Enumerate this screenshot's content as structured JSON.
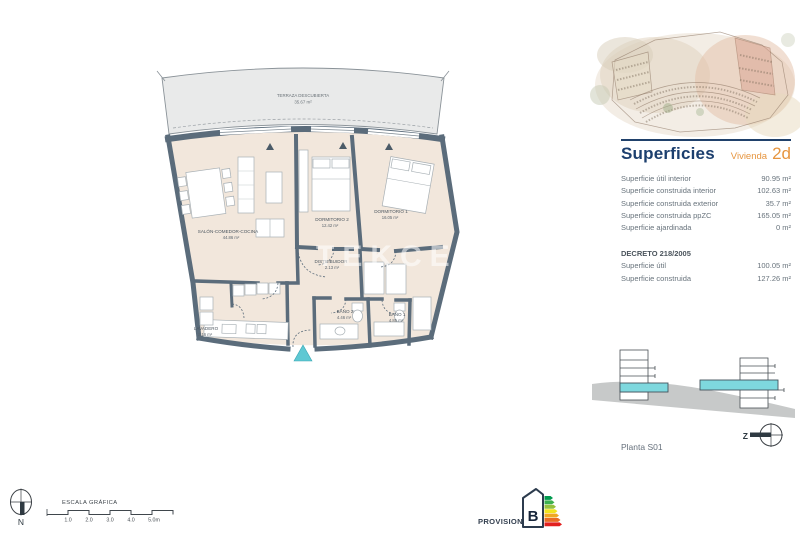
{
  "watermark": "TEKCE",
  "plan": {
    "terrace": {
      "name": "TERRAZA DESCUBIERTA",
      "area": "35.67 m²"
    },
    "rooms": [
      {
        "name": "SALÓN-COMEDOR-COCINA",
        "area": "44.86 m²"
      },
      {
        "name": "DORMITORIO 2",
        "area": "12.42 m²"
      },
      {
        "name": "DORMITORIO 1",
        "area": "16.05 m²"
      },
      {
        "name": "DISTRIBUIDOR",
        "area": "2.13 m²"
      },
      {
        "name": "LAVADERO",
        "area": "2.16 m²"
      },
      {
        "name": "BAÑO 2",
        "area": "4.46 m²"
      },
      {
        "name": "BAÑO 1",
        "area": "4.85 m²"
      }
    ]
  },
  "panel": {
    "title": "Superficies",
    "unit_label": "Vivienda",
    "unit_value": "2d",
    "rows": [
      {
        "label": "Superficie útil interior",
        "value": "90.95 m²"
      },
      {
        "label": "Superficie construida interior",
        "value": "102.63 m²"
      },
      {
        "label": "Superficie construida exterior",
        "value": "35.7 m²"
      },
      {
        "label": "Superficie construida ppZC",
        "value": "165.05 m²"
      },
      {
        "label": "Superficie ajardinada",
        "value": "0 m²"
      }
    ],
    "decreto": {
      "heading": "DECRETO 218/2005",
      "rows": [
        {
          "label": "Superficie útil",
          "value": "100.05 m²"
        },
        {
          "label": "Superficie construida",
          "value": "127.26 m²"
        }
      ]
    },
    "floor_label": "Planta S01",
    "section_compass_letter": "Z"
  },
  "footer": {
    "north_letter": "N",
    "scale_title": "ESCALA GRÁFICA",
    "scale_ticks": [
      "1.0",
      "2.0",
      "3.0",
      "4.0",
      "5.0m"
    ],
    "provisional": "PROVISIONAL",
    "energy_rating": "B"
  },
  "colors": {
    "wall": "#5b6c7b",
    "floor": "#f2e7dc",
    "terrace": "#e9eaea",
    "accent_teal": "#5ec8d3",
    "section_slab_teal": "#7ed8de",
    "navy": "#1c3f6e",
    "orange": "#e6953f",
    "ground_gray": "#c7c9c9",
    "energy_scale": [
      "#009a4e",
      "#3cb04e",
      "#95c13d",
      "#f2e41f",
      "#f0a823",
      "#ea6c24",
      "#e2201f"
    ]
  }
}
